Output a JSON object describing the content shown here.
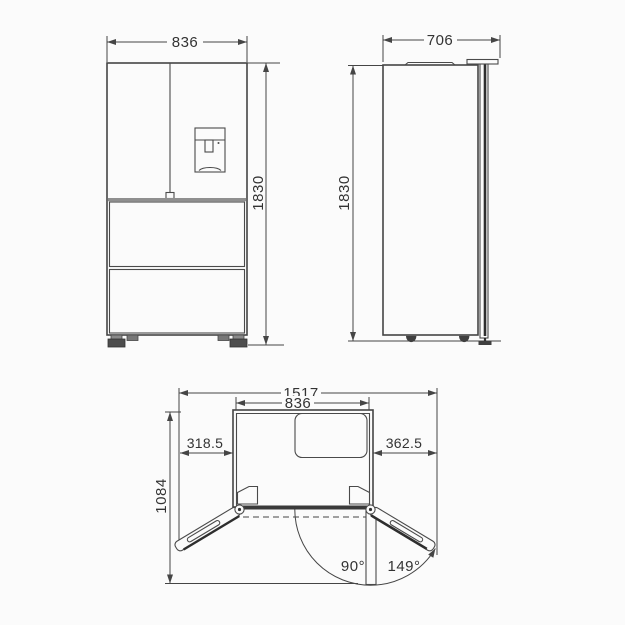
{
  "colors": {
    "background": "#fbfbfb",
    "line": "#454545",
    "dark_fill": "#3c3c3c",
    "text": "#333333"
  },
  "front_view": {
    "width_label": "836",
    "height_label": "1830"
  },
  "side_view": {
    "depth_label": "706",
    "height_label": "1830"
  },
  "top_view": {
    "overall_width_label": "1517",
    "cabinet_width_label": "836",
    "left_door_projection_label": "318.5",
    "right_door_projection_label": "362.5",
    "open_depth_label": "1084",
    "door_angle_90_label": "90°",
    "door_angle_149_label": "149°"
  }
}
